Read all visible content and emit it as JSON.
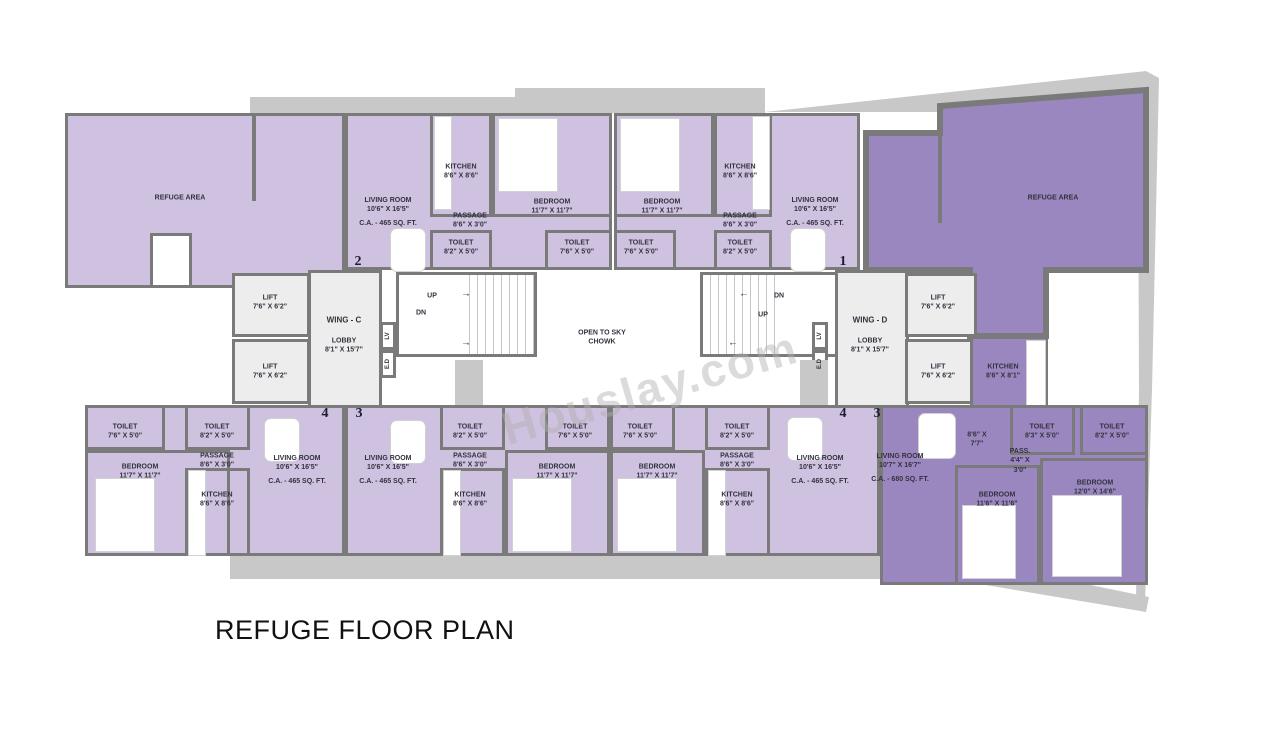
{
  "title": "REFUGE FLOOR PLAN",
  "watermark": "Houslay.com",
  "colors": {
    "unit_light": "#cfc2e0",
    "unit_dark": "#9b87c0",
    "wall": "#7a7a7a",
    "terrace": "#c8c8c8",
    "core": "#ededed"
  },
  "refuge_left": {
    "label": "REFUGE AREA"
  },
  "refuge_right": {
    "label": "REFUGE AREA"
  },
  "chowk": {
    "line1": "OPEN TO SKY",
    "line2": "CHOWK"
  },
  "arrows": {
    "right": "→",
    "left": "←"
  },
  "wing_c": {
    "name": "WING - C",
    "lobby_name": "LOBBY",
    "lobby_dim": "8'1\" X 15'7\"",
    "lift_name": "LIFT",
    "lift_dim": "7'6\" X 6'2\"",
    "up": "UP",
    "dn": "DN",
    "lv": "LV",
    "ed": "E.D"
  },
  "wing_d": {
    "name": "WING - D",
    "lobby_name": "LOBBY",
    "lobby_dim": "8'1\" X 15'7\"",
    "lift_name": "LIFT",
    "lift_dim": "7'6\" X 6'2\"",
    "up": "UP",
    "dn": "DN",
    "lv": "LV",
    "ed": "E.D"
  },
  "units": {
    "c2": {
      "number": "2",
      "living": {
        "name": "LIVING ROOM",
        "dim": "10'6\" X 16'5\"",
        "area": "C.A. - 465 SQ. FT."
      },
      "kitchen": {
        "name": "KITCHEN",
        "dim": "8'6\" X 8'6\""
      },
      "passage": {
        "name": "PASSAGE",
        "dim": "8'6\" X 3'0\""
      },
      "bedroom": {
        "name": "BEDROOM",
        "dim": "11'7\" X 11'7\""
      },
      "toilet_a": {
        "name": "TOILET",
        "dim": "8'2\" X 5'0\""
      },
      "toilet_b": {
        "name": "TOILET",
        "dim": "7'6\" X 5'0\""
      }
    },
    "d1": {
      "number": "1",
      "bedroom": {
        "name": "BEDROOM",
        "dim": "11'7\" X 11'7\""
      },
      "kitchen": {
        "name": "KITCHEN",
        "dim": "8'6\" X 8'6\""
      },
      "passage": {
        "name": "PASSAGE",
        "dim": "8'6\" X 3'0\""
      },
      "living": {
        "name": "LIVING ROOM",
        "dim": "10'6\" X 16'5\"",
        "area": "C.A. - 465 SQ. FT."
      },
      "toilet_a": {
        "name": "TOILET",
        "dim": "7'6\" X 5'0\""
      },
      "toilet_b": {
        "name": "TOILET",
        "dim": "8'2\" X 5'0\""
      }
    },
    "c4": {
      "number": "4",
      "toilet_a": {
        "name": "TOILET",
        "dim": "7'6\" X 5'0\""
      },
      "toilet_b": {
        "name": "TOILET",
        "dim": "8'2\" X 5'0\""
      },
      "passage": {
        "name": "PASSAGE",
        "dim": "8'6\" X 3'0\""
      },
      "bedroom": {
        "name": "BEDROOM",
        "dim": "11'7\" X 11'7\""
      },
      "kitchen": {
        "name": "KITCHEN",
        "dim": "8'6\" X 8'6\""
      },
      "living": {
        "name": "LIVING ROOM",
        "dim": "10'6\" X 16'5\"",
        "area": "C.A. - 465 SQ. FT."
      }
    },
    "c3": {
      "number": "3",
      "living": {
        "name": "LIVING ROOM",
        "dim": "10'6\" X 16'5\"",
        "area": "C.A. - 465 SQ. FT."
      },
      "toilet_a": {
        "name": "TOILET",
        "dim": "8'2\" X 5'0\""
      },
      "toilet_b": {
        "name": "TOILET",
        "dim": "7'6\" X 5'0\""
      },
      "passage": {
        "name": "PASSAGE",
        "dim": "8'6\" X 3'0\""
      },
      "kitchen": {
        "name": "KITCHEN",
        "dim": "8'6\" X 8'6\""
      },
      "bedroom": {
        "name": "BEDROOM",
        "dim": "11'7\" X 11'7\""
      }
    },
    "d4": {
      "number": "4",
      "toilet_a": {
        "name": "TOILET",
        "dim": "7'6\" X 5'0\""
      },
      "toilet_b": {
        "name": "TOILET",
        "dim": "8'2\" X 5'0\""
      },
      "passage": {
        "name": "PASSAGE",
        "dim": "8'6\" X 3'0\""
      },
      "bedroom": {
        "name": "BEDROOM",
        "dim": "11'7\" X 11'7\""
      },
      "kitchen": {
        "name": "KITCHEN",
        "dim": "8'6\" X 8'6\""
      },
      "living": {
        "name": "LIVING ROOM",
        "dim": "10'6\" X 16'5\"",
        "area": "C.A. - 465 SQ. FT."
      }
    },
    "d3": {
      "number": "3",
      "living": {
        "name": "LIVING ROOM",
        "dim": "10'7\" X 16'7\"",
        "area": "C.A. - 680 SQ. FT."
      },
      "foyer": {
        "dim1": "8'6\" X",
        "dim2": "7'7\""
      },
      "pass": {
        "name": "PASS.",
        "dim1": "4'4\" X",
        "dim2": "3'0\""
      },
      "kitchen": {
        "name": "KITCHEN",
        "dim": "8'6\" X 8'1\""
      },
      "toilet_a": {
        "name": "TOILET",
        "dim": "8'3\" X 5'0\""
      },
      "toilet_b": {
        "name": "TOILET",
        "dim": "8'2\" X 5'0\""
      },
      "bedroom_a": {
        "name": "BEDROOM",
        "dim": "11'6\" X 11'6\""
      },
      "bedroom_b": {
        "name": "BEDROOM",
        "dim": "12'0\" X 14'6\""
      }
    }
  }
}
